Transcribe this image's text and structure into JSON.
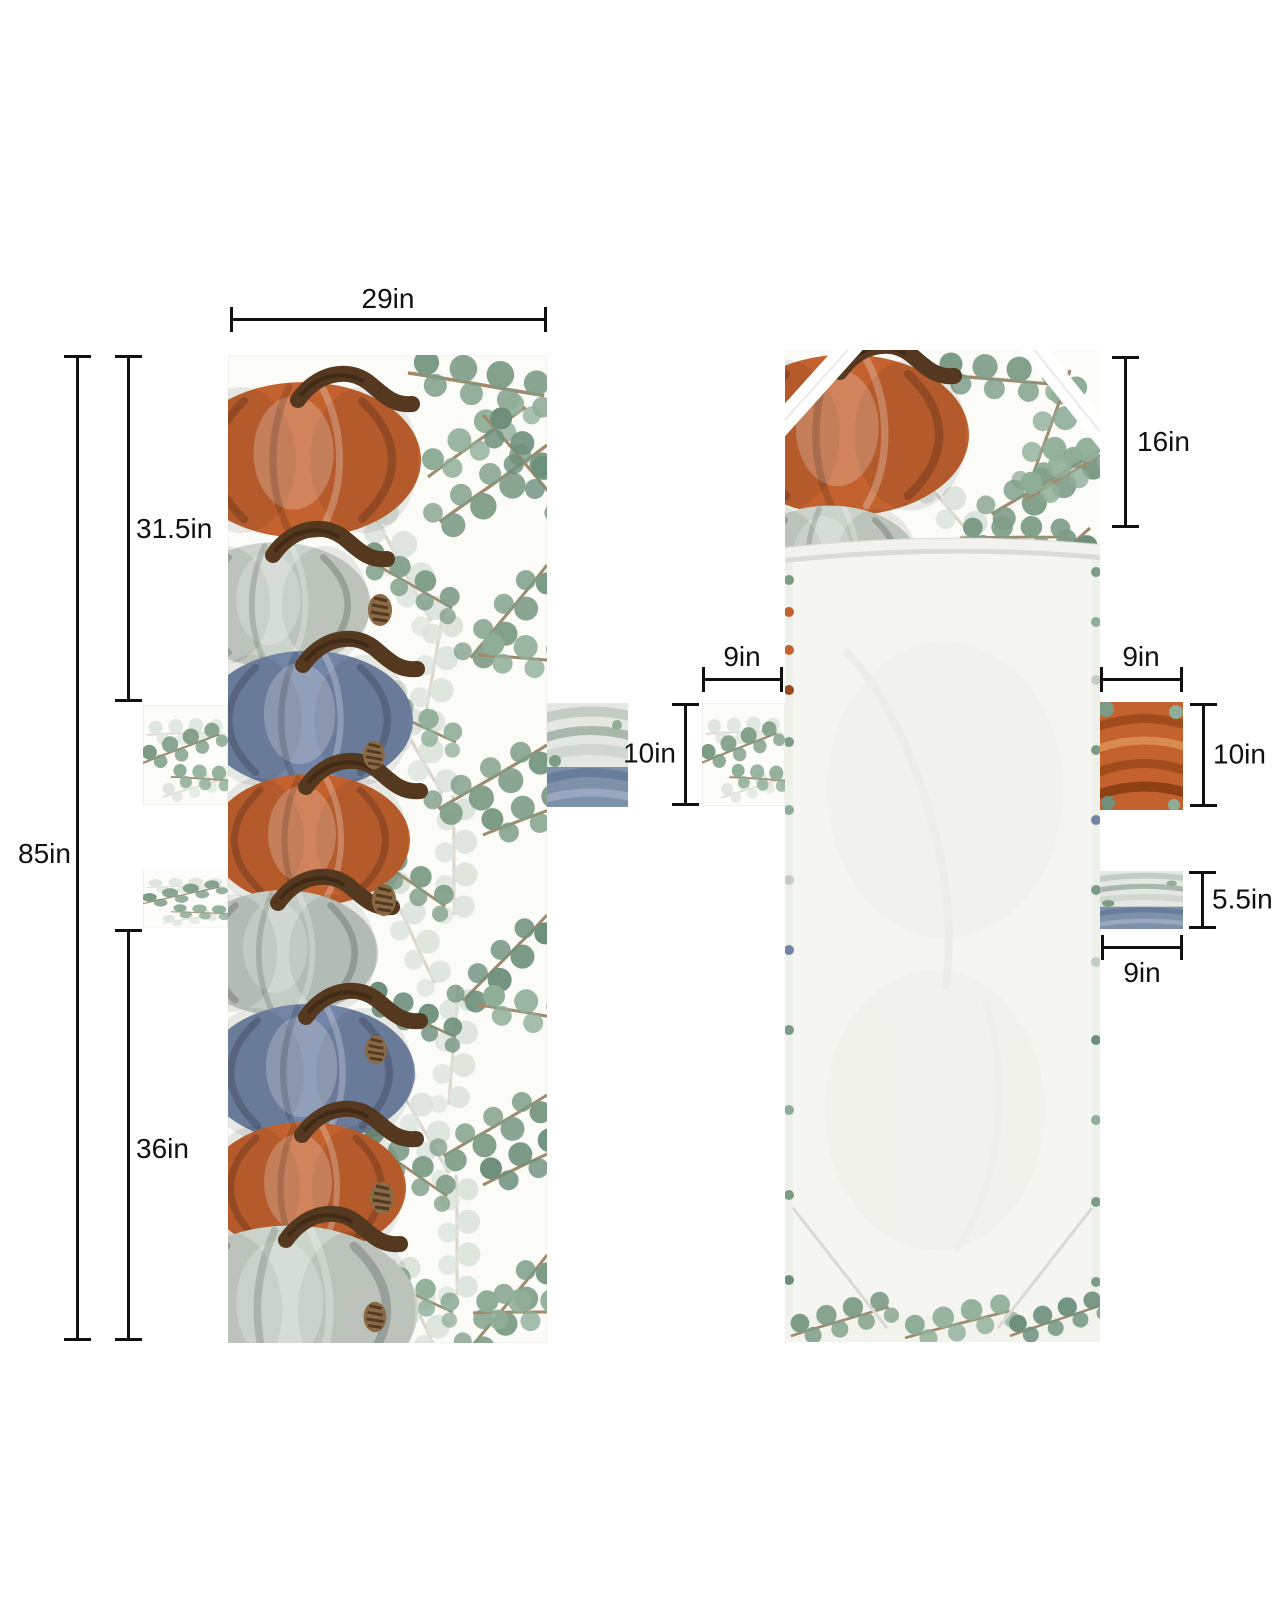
{
  "front_view": {
    "width_label": "29in",
    "total_height_label": "85in",
    "upper_section_height_label": "31.5in",
    "lower_section_height_label": "36in"
  },
  "back_view": {
    "top_pocket_height_label": "16in",
    "left_side_pocket": {
      "width_label": "9in",
      "height_label": "10in"
    },
    "right_upper_pocket": {
      "width_label": "9in",
      "height_label": "10in"
    },
    "right_lower_pocket": {
      "height_label": "5.5in",
      "width_label": "9in"
    }
  },
  "colors": {
    "dimension_lines": "#111111",
    "pumpkin_orange": "#c4622f",
    "pumpkin_blue": "#7385a6",
    "pumpkin_sage": "#cbd4cb",
    "eucalyptus_green": "#7d9c86",
    "fabric_background": "#fbfbf8",
    "liner_white": "#f5f5f2"
  }
}
